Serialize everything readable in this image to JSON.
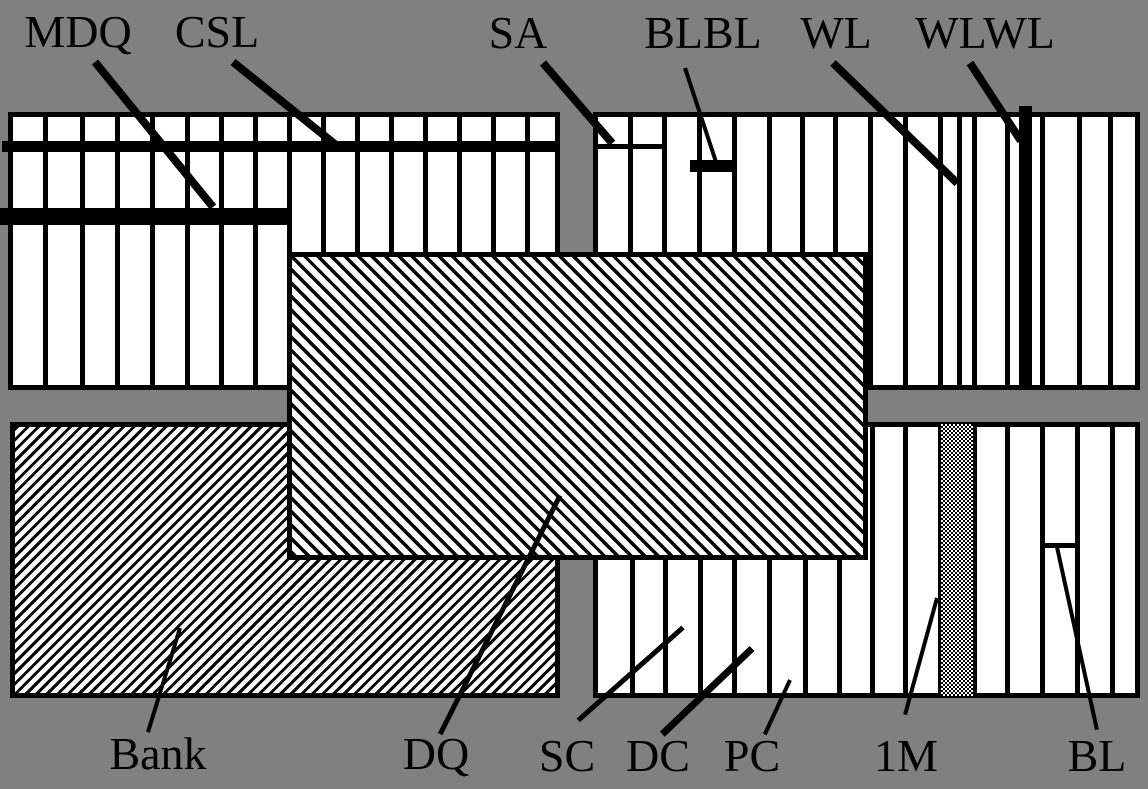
{
  "colors": {
    "background": "#808080",
    "ink": "#000000",
    "paper": "#ffffff"
  },
  "figure": {
    "width": 1148,
    "height": 789,
    "description": "DRAM bank floorplan diagram with labeled cell arrays, bank block, DQ region, word/bit lines",
    "blocks": [
      {
        "name": "array-top-left",
        "x": 8,
        "y": 112,
        "w": 552,
        "h": 278,
        "pattern": "vlines",
        "lines": [
          35,
          72,
          107,
          142,
          177,
          211,
          245,
          279,
          313,
          347,
          381,
          415,
          449,
          483,
          517
        ]
      },
      {
        "name": "array-top-right",
        "x": 593,
        "y": 112,
        "w": 547,
        "h": 278,
        "pattern": "vlines",
        "lines": [
          35,
          69,
          104,
          139,
          174,
          207,
          240,
          275,
          310,
          345,
          364,
          379,
          412,
          447,
          484,
          515
        ]
      },
      {
        "name": "bank-block",
        "x": 10,
        "y": 422,
        "w": 550,
        "h": 276,
        "pattern": "hatch-fwd"
      },
      {
        "name": "array-bottom-right",
        "x": 593,
        "y": 422,
        "w": 547,
        "h": 276,
        "pattern": "vlines",
        "lines": [
          37,
          70,
          105,
          139,
          174,
          210,
          244,
          277,
          310,
          345,
          379,
          412,
          447,
          482,
          517
        ]
      },
      {
        "name": "dq-region",
        "x": 287,
        "y": 252,
        "w": 581,
        "h": 308,
        "pattern": "hatch-back"
      }
    ],
    "bars": [
      {
        "name": "csl-bar",
        "x": 2,
        "y": 141,
        "w": 556,
        "h": 11,
        "fill": "black"
      },
      {
        "name": "mdq-bar",
        "x": 0,
        "y": 208,
        "w": 292,
        "h": 17,
        "fill": "black"
      },
      {
        "name": "wlwl-bar",
        "x": 1019,
        "y": 106,
        "w": 13,
        "h": 284,
        "fill": "black"
      },
      {
        "name": "sa-tick",
        "x": 593,
        "y": 144,
        "w": 69,
        "h": 5,
        "fill": "black"
      },
      {
        "name": "blbl-tick",
        "x": 690,
        "y": 160,
        "w": 43,
        "h": 12,
        "fill": "black"
      },
      {
        "name": "bl-tick",
        "x": 1040,
        "y": 543,
        "w": 36,
        "h": 5,
        "fill": "black"
      },
      {
        "name": "one-meg-column",
        "x": 941,
        "y": 424,
        "w": 32,
        "h": 272,
        "fill": "checker"
      }
    ],
    "leaders": [
      {
        "name": "mdq-leader",
        "x1": 95,
        "y1": 62,
        "x2": 213,
        "y2": 207,
        "w": 8
      },
      {
        "name": "csl-leader",
        "x1": 233,
        "y1": 62,
        "x2": 336,
        "y2": 145,
        "w": 8
      },
      {
        "name": "sa-leader",
        "x1": 543,
        "y1": 63,
        "x2": 612,
        "y2": 143,
        "w": 8
      },
      {
        "name": "blbl-leader",
        "x1": 685,
        "y1": 68,
        "x2": 716,
        "y2": 162,
        "w": 4
      },
      {
        "name": "wl-leader",
        "x1": 833,
        "y1": 63,
        "x2": 957,
        "y2": 183,
        "w": 8
      },
      {
        "name": "wlwl-leader",
        "x1": 970,
        "y1": 63,
        "x2": 1021,
        "y2": 141,
        "w": 8
      },
      {
        "name": "bank-leader",
        "x1": 180,
        "y1": 628,
        "x2": 148,
        "y2": 732,
        "w": 4
      },
      {
        "name": "dq-leader",
        "x1": 560,
        "y1": 495,
        "x2": 440,
        "y2": 734,
        "w": 5
      },
      {
        "name": "sc-leader",
        "x1": 683,
        "y1": 627,
        "x2": 578,
        "y2": 720,
        "w": 5
      },
      {
        "name": "dc-leader",
        "x1": 752,
        "y1": 648,
        "x2": 662,
        "y2": 734,
        "w": 7
      },
      {
        "name": "pc-leader",
        "x1": 790,
        "y1": 680,
        "x2": 765,
        "y2": 734,
        "w": 4
      },
      {
        "name": "one-meg-leader",
        "x1": 937,
        "y1": 598,
        "x2": 905,
        "y2": 715,
        "w": 4
      },
      {
        "name": "bl-leader",
        "x1": 1057,
        "y1": 547,
        "x2": 1097,
        "y2": 730,
        "w": 4
      }
    ],
    "labels": [
      {
        "name": "label-mdq",
        "text": "MDQ",
        "x": 78,
        "y": 9
      },
      {
        "name": "label-csl",
        "text": "CSL",
        "x": 217,
        "y": 9
      },
      {
        "name": "label-sa",
        "text": "SA",
        "x": 518,
        "y": 10
      },
      {
        "name": "label-blbl",
        "text": "BLBL",
        "x": 703,
        "y": 10
      },
      {
        "name": "label-wl",
        "text": "WL",
        "x": 836,
        "y": 10
      },
      {
        "name": "label-wlwl",
        "text": "WLWL",
        "x": 985,
        "y": 10
      },
      {
        "name": "label-bank",
        "text": "Bank",
        "x": 158,
        "y": 731
      },
      {
        "name": "label-dq",
        "text": "DQ",
        "x": 436,
        "y": 731
      },
      {
        "name": "label-sc",
        "text": "SC",
        "x": 567,
        "y": 733
      },
      {
        "name": "label-dc",
        "text": "DC",
        "x": 658,
        "y": 733
      },
      {
        "name": "label-pc",
        "text": "PC",
        "x": 752,
        "y": 733
      },
      {
        "name": "label-1m",
        "text": "1M",
        "x": 906,
        "y": 733
      },
      {
        "name": "label-bl",
        "text": "BL",
        "x": 1097,
        "y": 733
      }
    ]
  }
}
